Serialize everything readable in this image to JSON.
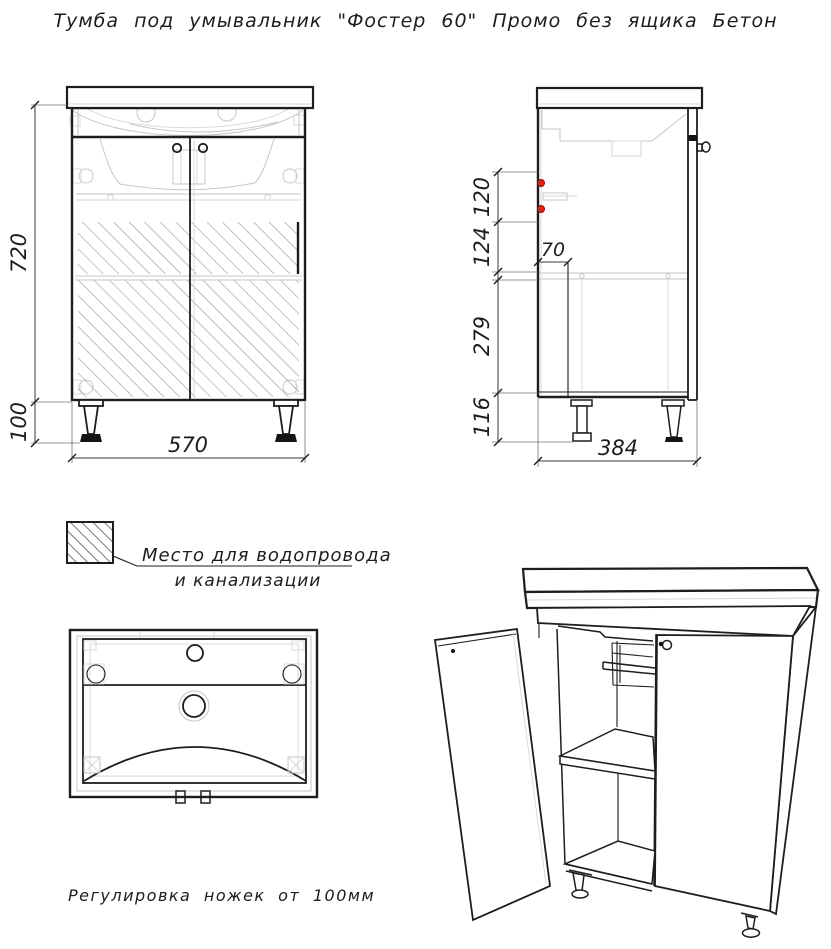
{
  "title": "Тумба под умывальник \"Фостер 60\" Промо без ящика Бетон",
  "front_view": {
    "height": "720",
    "legs_height": "100",
    "width": "570"
  },
  "side_view": {
    "upper_gap": "120",
    "middle_gap": "124",
    "plumbing_depth": "70",
    "lower_gap": "279",
    "bottom_gap": "116",
    "depth": "384"
  },
  "legend": {
    "line1": "Место для водопровода",
    "line2": "и канализации"
  },
  "note": "Регулировка ножек от 100мм",
  "colors": {
    "line": "#1d1d1d",
    "hidden_line": "#c6c6c6",
    "hatch": "#8f8f8f",
    "accent_red": "#e02318"
  }
}
